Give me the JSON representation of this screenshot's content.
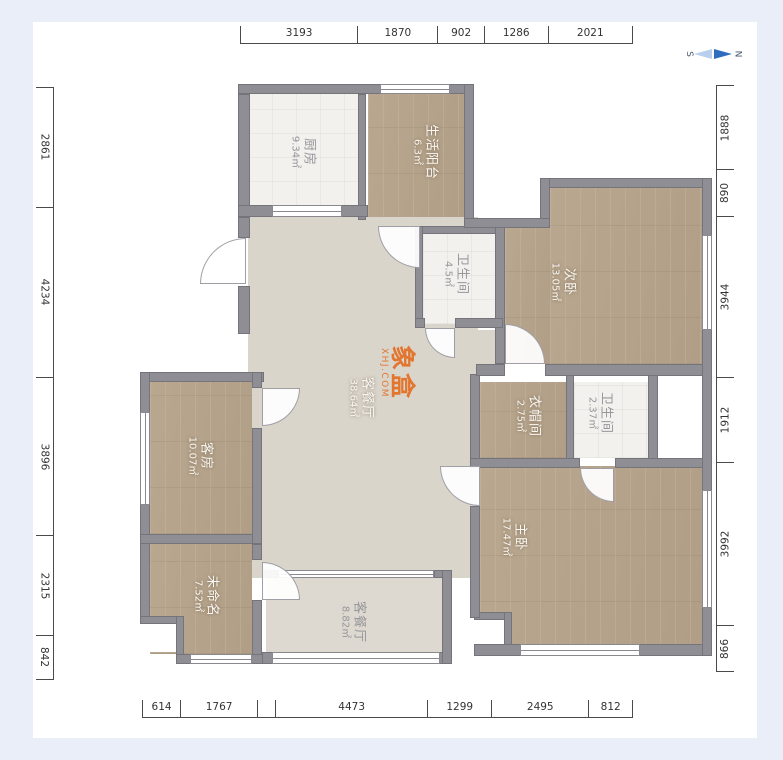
{
  "page": {
    "background": "#ffffff",
    "margin_color": "#e9eef8"
  },
  "compass": {
    "south": "S",
    "north": "N",
    "needle_color": "#2f6cc0"
  },
  "watermark": {
    "line1": "象盒",
    "line2": "XHJ.COM",
    "color": "#e2762f"
  },
  "dimensions": {
    "top": [
      "3193",
      "1870",
      "902",
      "1286",
      "2021"
    ],
    "bottom": [
      "614",
      "1767",
      "4473",
      "1299",
      "2495",
      "812"
    ],
    "left": [
      "2861",
      "4234",
      "3896",
      "2315",
      "842"
    ],
    "right": [
      "1888",
      "890",
      "3944",
      "1912",
      "3992",
      "866"
    ]
  },
  "rooms": [
    {
      "id": "kitchen",
      "name": "厨房",
      "area": "9.34㎡"
    },
    {
      "id": "living-balcony",
      "name": "生活阳台",
      "area": "6.3㎡"
    },
    {
      "id": "bathroom-1",
      "name": "卫生间",
      "area": "4.5㎡"
    },
    {
      "id": "second-bedroom",
      "name": "次卧",
      "area": "13.05㎡"
    },
    {
      "id": "living-dining",
      "name": "客餐厅",
      "area": "38.64㎡"
    },
    {
      "id": "cloakroom",
      "name": "衣帽间",
      "area": "2.75㎡"
    },
    {
      "id": "bathroom-2",
      "name": "卫生间",
      "area": "2.37㎡"
    },
    {
      "id": "master-bedroom",
      "name": "主卧",
      "area": "17.47㎡"
    },
    {
      "id": "guest-room",
      "name": "客房",
      "area": "10.07㎡"
    },
    {
      "id": "unnamed",
      "name": "未命名",
      "area": "7.52㎡"
    },
    {
      "id": "south-balcony",
      "name": "客餐厅",
      "area": "8.82㎡"
    }
  ],
  "colors": {
    "wall": "#8f8e94",
    "wood_floor": "#b5a38c",
    "living_floor": "#dad5cb",
    "tile_floor": "#f2f1ee",
    "dimension_line": "#4a4a4a"
  }
}
